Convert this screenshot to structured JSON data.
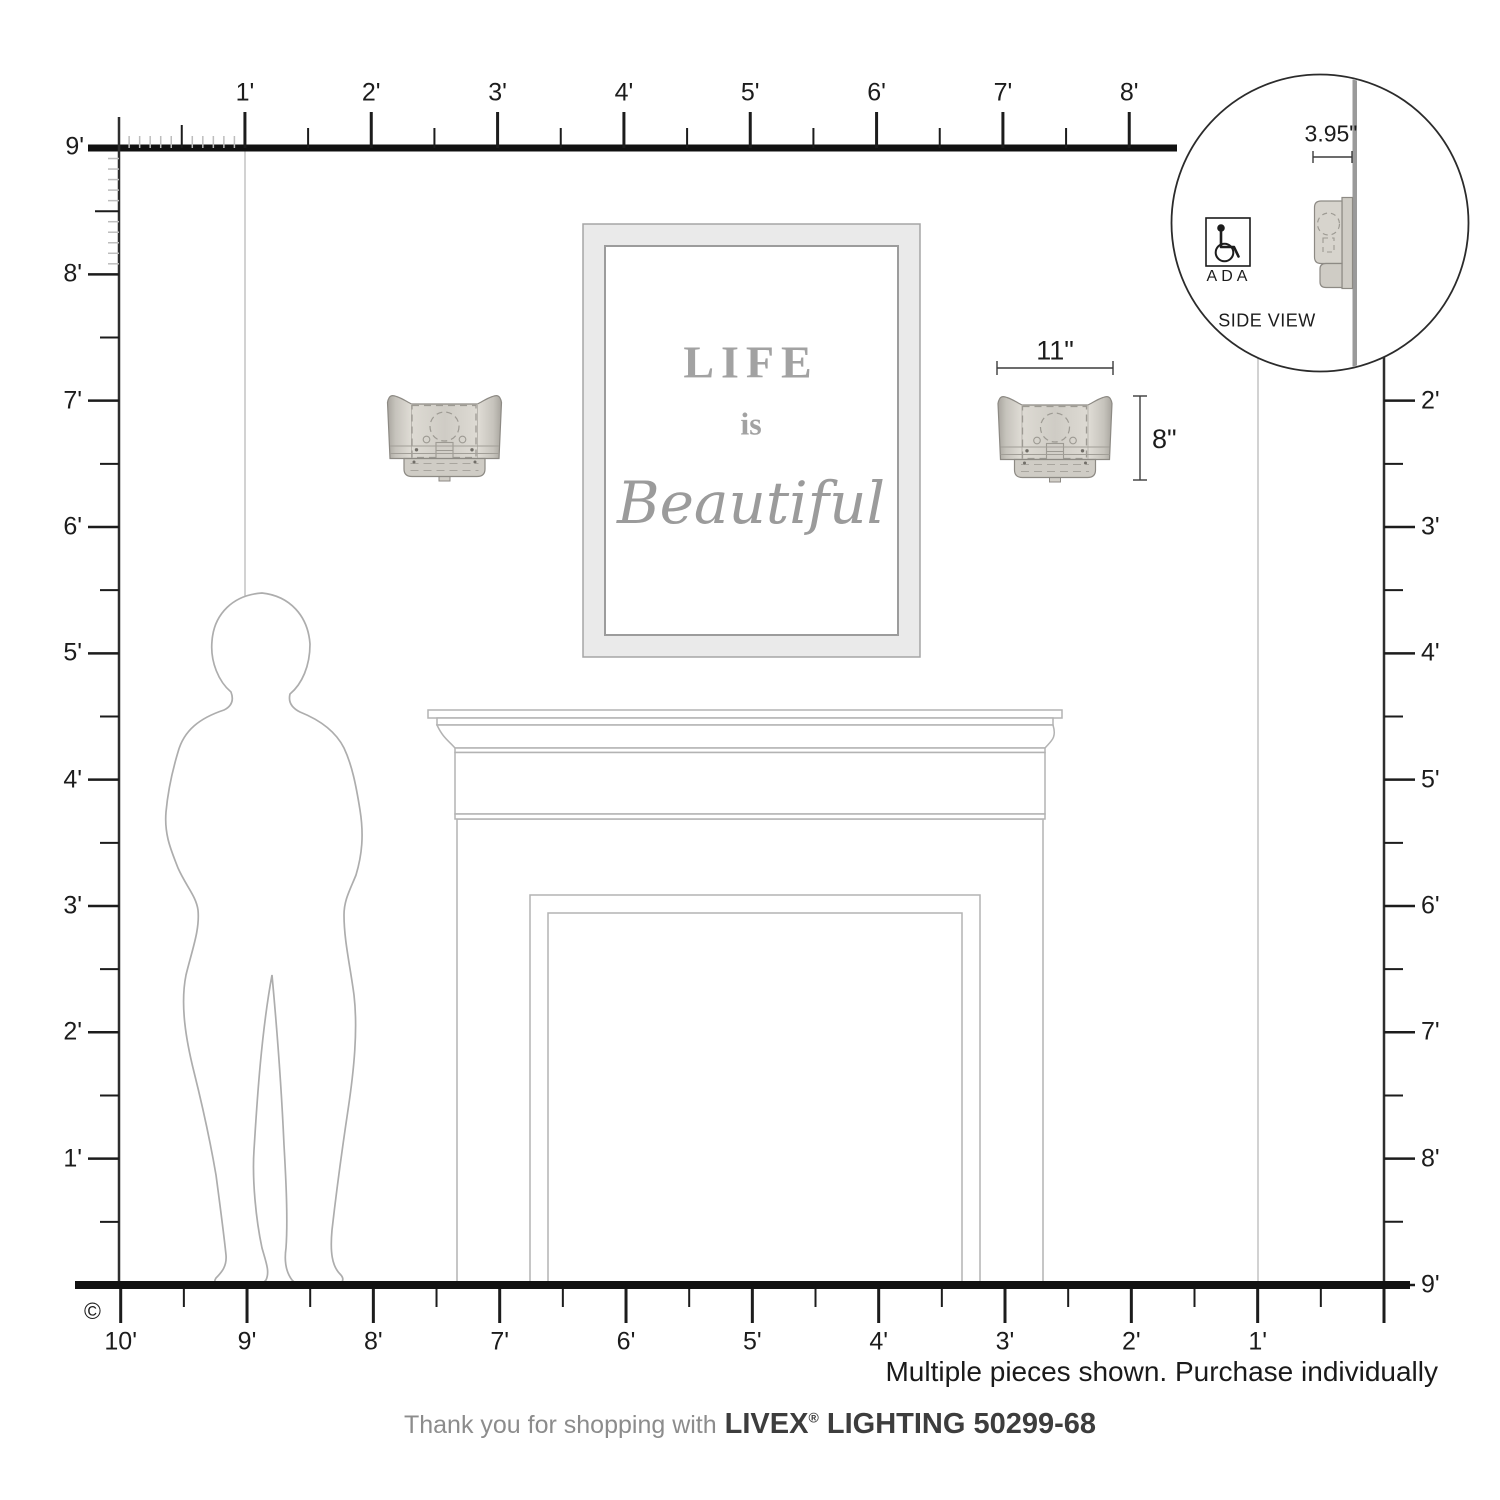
{
  "title": "Livex Lighting wall sconce scale diagram",
  "rulers": {
    "top": {
      "origin_label": "9'",
      "labels": [
        "1'",
        "2'",
        "3'",
        "4'",
        "5'",
        "6'",
        "7'",
        "8'"
      ]
    },
    "left": {
      "labels": [
        "8'",
        "7'",
        "6'",
        "5'",
        "4'",
        "3'",
        "2'",
        "1'"
      ]
    },
    "right": {
      "labels": [
        "2'",
        "3'",
        "4'",
        "5'",
        "6'",
        "7'",
        "8'",
        "9'"
      ]
    },
    "bottom": {
      "labels": [
        "10'",
        "9'",
        "8'",
        "7'",
        "6'",
        "5'",
        "4'",
        "3'",
        "2'",
        "1'"
      ]
    }
  },
  "dimensions": {
    "fixture_width": "11\"",
    "fixture_height": "8\"",
    "fixture_depth": "3.95\""
  },
  "inset": {
    "ada_label": "ADA",
    "title": "SIDE VIEW"
  },
  "artwork": {
    "line1": "LIFE",
    "line2": "is",
    "line3": "Beautiful"
  },
  "note": "Multiple pieces shown. Purchase individually",
  "footer": {
    "prefix": "Thank you for shopping with",
    "brand": "LIVEX",
    "registered": "®",
    "suffix": "LIGHTING 50299-68"
  },
  "copyright": "©",
  "colors": {
    "ink": "#1c1c1c",
    "ruler_line": "#111111",
    "drawing_outline": "#b3b3b3",
    "figure_outline": "#adadad",
    "shade_light": "#dedbd4",
    "shade_dark": "#a8a59e",
    "frame_band": "#eaeaea",
    "art_text": "#a2a2a2",
    "wall_line": "#9a9a9a"
  }
}
